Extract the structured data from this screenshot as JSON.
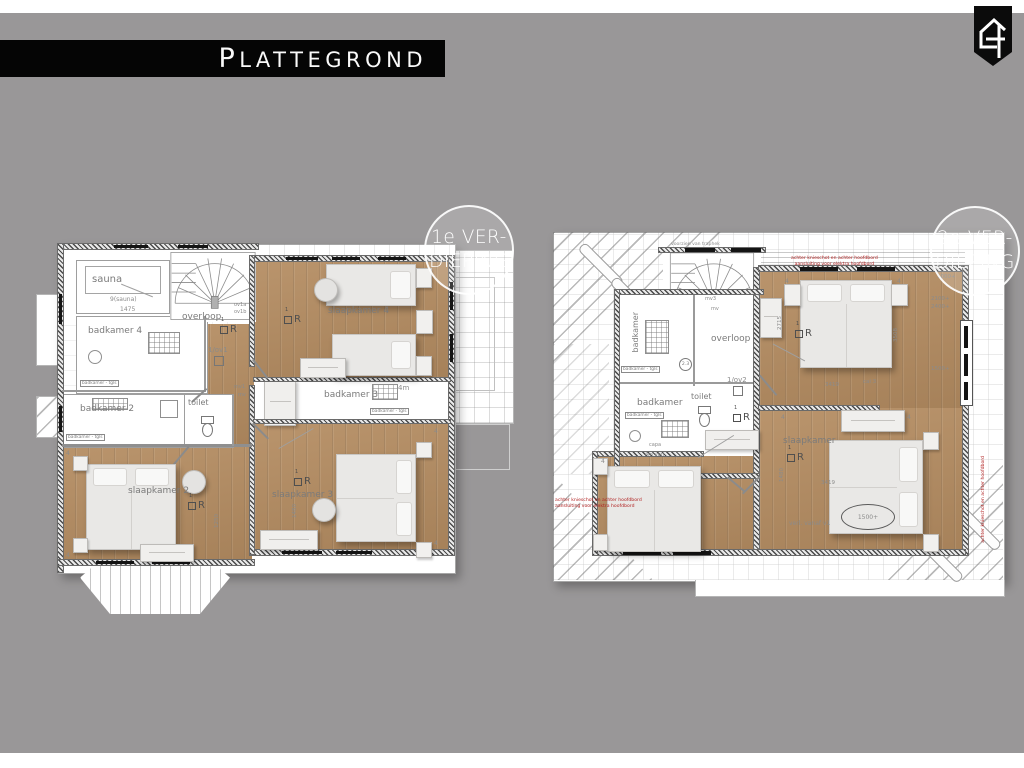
{
  "header": {
    "title": "PLATTEGROND"
  },
  "logo": {
    "icon": "house-number-4-pennant"
  },
  "badges": {
    "floor1": [
      "1e VER-",
      "DIEPING"
    ],
    "floor2": [
      "2e VER-",
      "DIEPING"
    ]
  },
  "markers": {
    "one": "1",
    "r": "R"
  },
  "colors": {
    "background": "#999798",
    "title_bar": "#050505",
    "wood_floor": "#b48c61",
    "badge_border": "#ffffff",
    "red_note": "#b12222",
    "label_gray": "#7b7b7b"
  },
  "plan1": {
    "name": "1e verdieping plattegrond",
    "labels": {
      "sauna": "sauna",
      "sauna_ref": "9(sauna)",
      "sauna_dim": "1475",
      "badkamer4": "badkamer 4",
      "badkamer2": "badkamer 2",
      "badkamer3": "badkamer 3",
      "badkamer3_size": "4m",
      "toilet": "toilet",
      "overloop": "overloop",
      "ov1": "1/ov1",
      "ov1a": "ov1a",
      "ov1b": "ov1b",
      "mv1": "mv1",
      "mv": "mv",
      "slaapkamer4": "slaapkamer 4",
      "slaapkamer2": "slaapkamer 2",
      "slaapkamer3": "slaapkamer 3",
      "tiles_note": "badkamer - tgls",
      "dim1480": "1480",
      "dim1250": "1250",
      "four": "4"
    }
  },
  "plan2": {
    "name": "2e verdieping plattegrond",
    "labels": {
      "overloop": "overloop",
      "mv3": "mv3",
      "mv": "mv",
      "badkamer_boven": "badkamer",
      "badkamer_onder": "badkamer",
      "toilet": "toilet",
      "ov2": "1/ov2",
      "marker23": "2.3",
      "capa": "capa",
      "verl4m": "4m verl",
      "slaapkamer": "slaapkamer",
      "verl_v1": "verl. vanaf v1",
      "oval1500": "1500+",
      "stair_note": "voorzien van traphek",
      "tiles_note": "badkamer - tgls",
      "d3419": "3419",
      "dcal3": "cal 3",
      "d2100": "2100+",
      "d2400": "2400+",
      "d1000": "1000+",
      "d1500": "1500+",
      "d3508": "3508",
      "d2715": "2715",
      "d1480": "1480",
      "d3419b": "3419",
      "rednote1": "achter knieschot en achter hoofdbord",
      "rednote2": "aansluiting voor elektra hoofdbord",
      "four": "4"
    }
  }
}
